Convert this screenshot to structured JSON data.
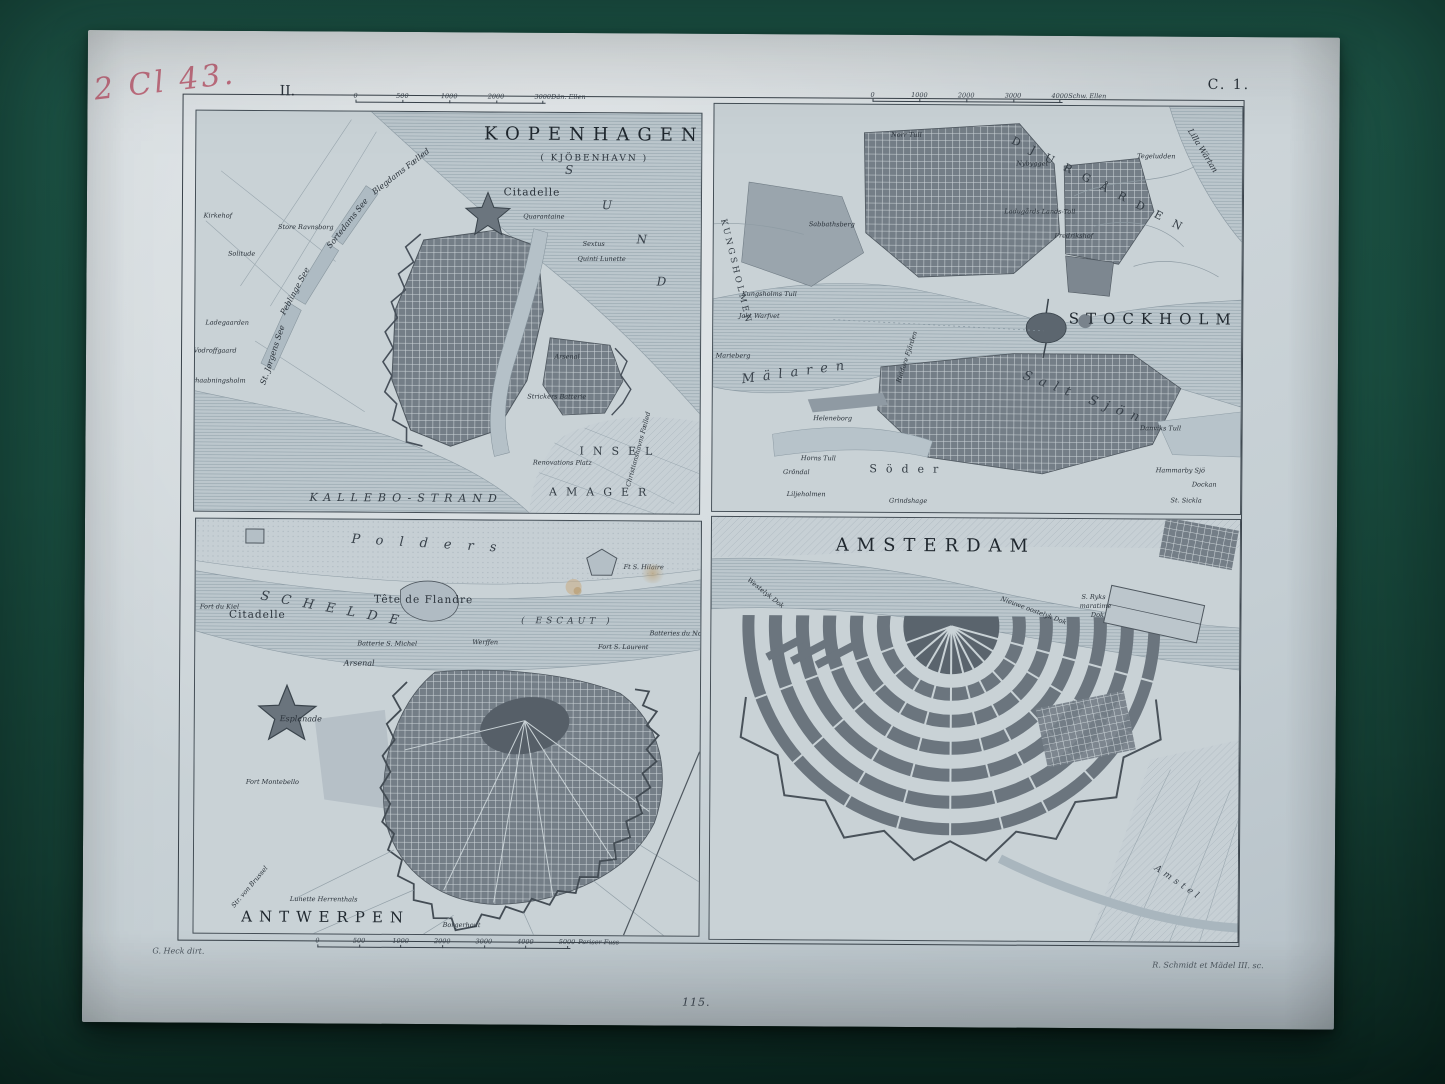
{
  "photo": {
    "background_color": "#1b5143",
    "paper_color": "#cdd5d9",
    "ink_color": "#2a323a",
    "handwriting_color": "#bb5a6e"
  },
  "annotations": {
    "handwritten": "2 Cl 43.",
    "plate_number_top_left": "II.",
    "plate_code_top_right": "C. 1.",
    "page_number_bottom": "115.",
    "credit_left": "G. Heck dirt.",
    "credit_right": "R. Schmidt et Mädel III. sc."
  },
  "maps": {
    "kopenhagen": {
      "scalebar": {
        "ticks": [
          "0",
          "500",
          "1000",
          "2000",
          "3000"
        ],
        "unit": "Dän. Ellen"
      },
      "labels": [
        {
          "t": "KOPENHAGEN",
          "x": 398,
          "y": 22,
          "c": "t1"
        },
        {
          "t": "( KJÖBENHAVN )",
          "x": 398,
          "y": 46,
          "c": "t2"
        },
        {
          "t": "S",
          "x": 374,
          "y": 57,
          "c": "sea"
        },
        {
          "t": "U",
          "x": 412,
          "y": 92,
          "c": "sea"
        },
        {
          "t": "N",
          "x": 447,
          "y": 126,
          "c": "sea"
        },
        {
          "t": "D",
          "x": 467,
          "y": 168,
          "c": "sea"
        },
        {
          "t": "Citadelle",
          "x": 336,
          "y": 80,
          "c": "med"
        },
        {
          "t": "Quarantaine",
          "x": 348,
          "y": 104,
          "c": "xs"
        },
        {
          "t": "Sextus",
          "x": 398,
          "y": 131,
          "c": "xs"
        },
        {
          "t": "Quinti Lunette",
          "x": 406,
          "y": 146,
          "c": "xs"
        },
        {
          "t": "Blegdams Fælled",
          "x": 205,
          "y": 60,
          "c": "sm",
          "r": -38
        },
        {
          "t": "Kirkehof",
          "x": 22,
          "y": 105,
          "c": "xs"
        },
        {
          "t": "Store Ravnsborg",
          "x": 110,
          "y": 116,
          "c": "xs"
        },
        {
          "t": "Solitude",
          "x": 46,
          "y": 143,
          "c": "xs"
        },
        {
          "t": "Sortedams See",
          "x": 152,
          "y": 112,
          "c": "sm",
          "r": -52
        },
        {
          "t": "Peblinge See",
          "x": 100,
          "y": 180,
          "c": "sm",
          "r": -62
        },
        {
          "t": "St. Jørgens See",
          "x": 78,
          "y": 244,
          "c": "sm",
          "r": -72
        },
        {
          "t": "Ladegaarden",
          "x": 32,
          "y": 212,
          "c": "xs"
        },
        {
          "t": "Vodroffgaard",
          "x": 20,
          "y": 240,
          "c": "xs"
        },
        {
          "t": "Forhaabningsholm",
          "x": 20,
          "y": 270,
          "c": "xs"
        },
        {
          "t": "Arsenal",
          "x": 372,
          "y": 244,
          "c": "xs"
        },
        {
          "t": "Strickers Batterie",
          "x": 362,
          "y": 284,
          "c": "xs"
        },
        {
          "t": "Christianshavns Fælled",
          "x": 444,
          "y": 336,
          "c": "xs",
          "r": -75
        },
        {
          "t": "Renovations Platz",
          "x": 368,
          "y": 350,
          "c": "xs"
        },
        {
          "t": "INSEL",
          "x": 426,
          "y": 338,
          "c": "spread2"
        },
        {
          "t": "AMAGER",
          "x": 408,
          "y": 379,
          "c": "spread2"
        },
        {
          "t": "KALLEBO-STRAND",
          "x": 212,
          "y": 386,
          "c": "spread"
        }
      ]
    },
    "stockholm": {
      "scalebar": {
        "ticks": [
          "0",
          "1000",
          "2000",
          "3000",
          "4000"
        ],
        "unit": "Schw. Ellen"
      },
      "labels": [
        {
          "t": "STOCKHOLM",
          "x": 440,
          "y": 213,
          "c": "t1b"
        },
        {
          "t": "DJURGÅRDEN",
          "x": 388,
          "y": 80,
          "c": "spread2",
          "r": 27,
          "ls": 12
        },
        {
          "t": "Lilla Wärtan",
          "x": 488,
          "y": 44,
          "c": "sm",
          "r": 58
        },
        {
          "t": "Tegeludden",
          "x": 442,
          "y": 50,
          "c": "xs"
        },
        {
          "t": "Nybygget",
          "x": 318,
          "y": 58,
          "c": "xs"
        },
        {
          "t": "Ladugårds Lands-Toll",
          "x": 326,
          "y": 106,
          "c": "xs"
        },
        {
          "t": "Fredrikshof",
          "x": 360,
          "y": 130,
          "c": "xs"
        },
        {
          "t": "Norr Tull",
          "x": 192,
          "y": 30,
          "c": "xs"
        },
        {
          "t": "Sabbathsberg",
          "x": 118,
          "y": 120,
          "c": "xs"
        },
        {
          "t": "Kungsholms Tull",
          "x": 56,
          "y": 190,
          "c": "xs"
        },
        {
          "t": "KUNGSHOLMEN",
          "x": 22,
          "y": 168,
          "c": "vert",
          "r": 76
        },
        {
          "t": "Marieberg",
          "x": 20,
          "y": 252,
          "c": "xs"
        },
        {
          "t": "Jakt Warfvet",
          "x": 46,
          "y": 212,
          "c": "xs"
        },
        {
          "t": "Mälaren",
          "x": 84,
          "y": 268,
          "c": "seaBig",
          "r": -8
        },
        {
          "t": "Riddare Fjärden",
          "x": 194,
          "y": 252,
          "c": "xs",
          "r": -72
        },
        {
          "t": "Heleneborg",
          "x": 120,
          "y": 314,
          "c": "xs"
        },
        {
          "t": "Horns Tull",
          "x": 106,
          "y": 354,
          "c": "xs"
        },
        {
          "t": "Söder",
          "x": 196,
          "y": 364,
          "c": "spread2"
        },
        {
          "t": "Salt Sjön",
          "x": 372,
          "y": 292,
          "c": "seaBig",
          "r": 20
        },
        {
          "t": "Danviks Tull",
          "x": 448,
          "y": 322,
          "c": "xs"
        },
        {
          "t": "Hammarby Sjö",
          "x": 468,
          "y": 364,
          "c": "xs"
        },
        {
          "t": "Dockan",
          "x": 492,
          "y": 378,
          "c": "xs"
        },
        {
          "t": "St. Sickla",
          "x": 474,
          "y": 394,
          "c": "xs"
        },
        {
          "t": "Grindshage",
          "x": 196,
          "y": 396,
          "c": "xs"
        },
        {
          "t": "Gröndal",
          "x": 84,
          "y": 368,
          "c": "xs"
        },
        {
          "t": "Liljeholmen",
          "x": 94,
          "y": 390,
          "c": "xs"
        }
      ]
    },
    "antwerpen": {
      "scalebar": {
        "ticks": [
          "0",
          "500",
          "1000",
          "2000",
          "3000",
          "4000",
          "5000"
        ],
        "unit": "Pariser Fuss"
      },
      "labels": [
        {
          "t": "ANTWERPEN",
          "x": 132,
          "y": 398,
          "c": "t1b"
        },
        {
          "t": "Polders",
          "x": 236,
          "y": 24,
          "c": "spreadIt",
          "r": 3
        },
        {
          "t": "SCHELDE",
          "x": 140,
          "y": 90,
          "c": "seaBig",
          "r": 10,
          "ls": 12
        },
        {
          "t": "( ESCAUT )",
          "x": 372,
          "y": 101,
          "c": "seaSm"
        },
        {
          "t": "Tête de Flandre",
          "x": 228,
          "y": 80,
          "c": "med"
        },
        {
          "t": "Ft S. Hilaire",
          "x": 448,
          "y": 46,
          "c": "xs"
        },
        {
          "t": "Fort du Kiel",
          "x": 24,
          "y": 88,
          "c": "xs"
        },
        {
          "t": "Citadelle",
          "x": 62,
          "y": 96,
          "c": "med"
        },
        {
          "t": "Arsenal",
          "x": 164,
          "y": 144,
          "c": "sm"
        },
        {
          "t": "Esplanade",
          "x": 106,
          "y": 200,
          "c": "sm"
        },
        {
          "t": "Fort Montebello",
          "x": 78,
          "y": 263,
          "c": "xs"
        },
        {
          "t": "Lunette Herrenthals",
          "x": 130,
          "y": 380,
          "c": "xs"
        },
        {
          "t": "Str. von Brussel",
          "x": 56,
          "y": 368,
          "c": "xs",
          "r": -50
        },
        {
          "t": "Borgerhout",
          "x": 268,
          "y": 405,
          "c": "xs"
        },
        {
          "t": "Batterie S. Michel",
          "x": 192,
          "y": 124,
          "c": "xs"
        },
        {
          "t": "Werffen",
          "x": 290,
          "y": 122,
          "c": "xs"
        },
        {
          "t": "Fort S. Laurent",
          "x": 428,
          "y": 126,
          "c": "xs"
        },
        {
          "t": "Batteries du Nord",
          "x": 484,
          "y": 112,
          "c": "xs"
        }
      ]
    },
    "amsterdam": {
      "labels": [
        {
          "t": "AMSTERDAM",
          "x": 224,
          "y": 28,
          "c": "t1"
        },
        {
          "t": "Westelyk Dok",
          "x": 54,
          "y": 76,
          "c": "xs",
          "r": 38
        },
        {
          "t": "Nieuwe oostelyk Dok",
          "x": 322,
          "y": 92,
          "c": "xs",
          "r": 20
        },
        {
          "t": "S. Ryks",
          "x": 382,
          "y": 78,
          "c": "xs"
        },
        {
          "t": "maratime",
          "x": 384,
          "y": 87,
          "c": "xs"
        },
        {
          "t": "Dok",
          "x": 386,
          "y": 96,
          "c": "xs"
        },
        {
          "t": "Amstel",
          "x": 468,
          "y": 364,
          "c": "seaSm",
          "r": 34
        }
      ]
    }
  }
}
